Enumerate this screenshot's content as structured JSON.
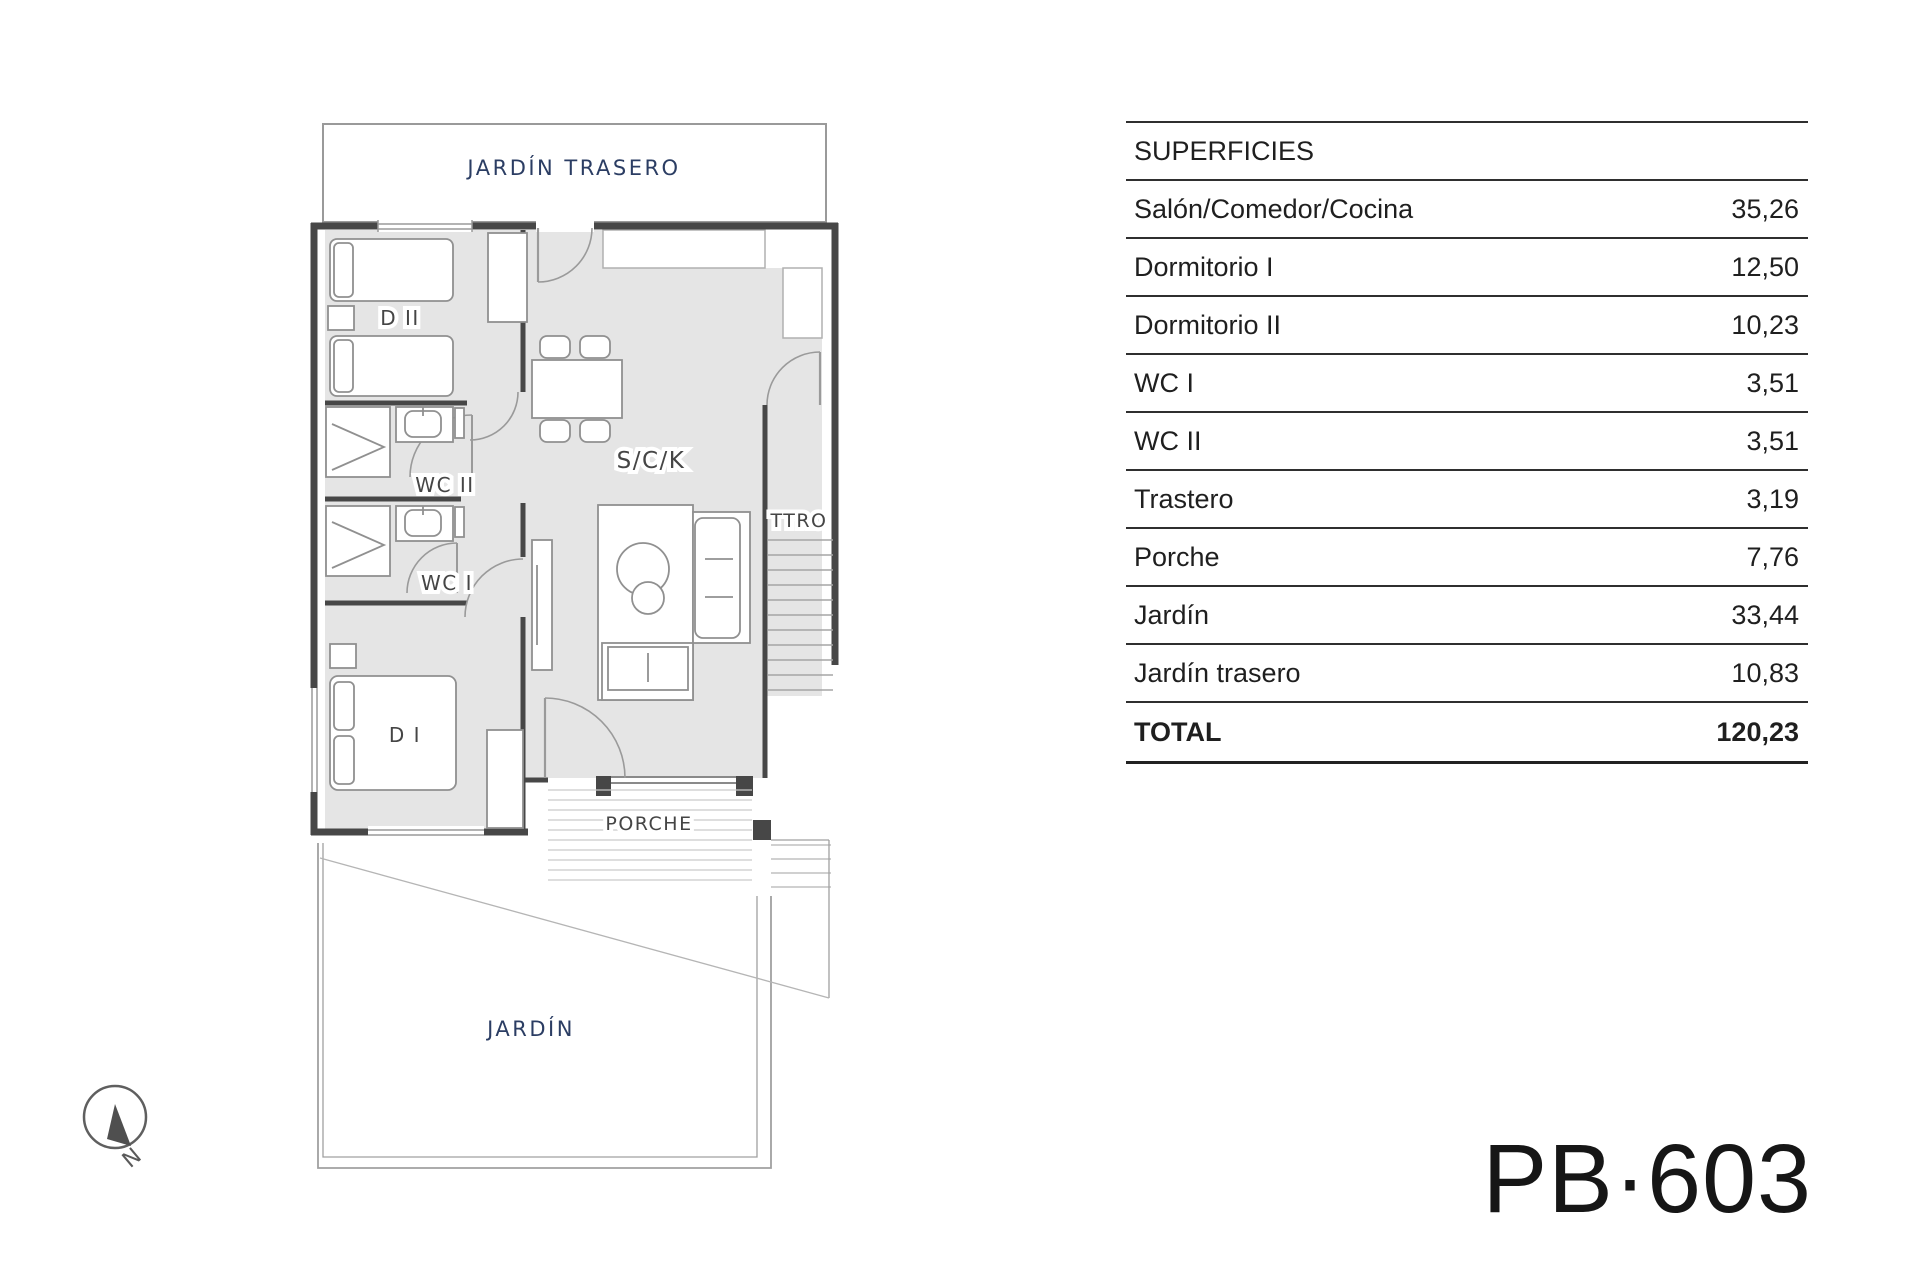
{
  "plan": {
    "labels": {
      "jardin_trasero": "JARDÍN TRASERO",
      "d2": "D II",
      "wc2": "WC II",
      "wc1": "WC I",
      "d1": "D I",
      "sck": "S/C/K",
      "ttro": "TTRO",
      "porche": "PORCHE",
      "jardin": "JARDÍN"
    },
    "compass": {
      "north_label": "N"
    },
    "colors": {
      "floor_fill": "#e5e5e5",
      "wall": "#474747",
      "room_label": "#454545",
      "garden_label": "#2b3d63"
    }
  },
  "surfaces_table": {
    "header": "SUPERFICIES",
    "rows": [
      {
        "label": "Salón/Comedor/Cocina",
        "value": "35,26"
      },
      {
        "label": "Dormitorio I",
        "value": "12,50"
      },
      {
        "label": "Dormitorio II",
        "value": "10,23"
      },
      {
        "label": "WC I",
        "value": "3,51"
      },
      {
        "label": "WC II",
        "value": "3,51"
      },
      {
        "label": "Trastero",
        "value": "3,19"
      },
      {
        "label": "Porche",
        "value": "7,76"
      },
      {
        "label": "Jardín",
        "value": "33,44"
      },
      {
        "label": "Jardín trasero",
        "value": "10,83"
      }
    ],
    "total": {
      "label": "TOTAL",
      "value": "120,23"
    }
  },
  "plan_code": "PB·603"
}
